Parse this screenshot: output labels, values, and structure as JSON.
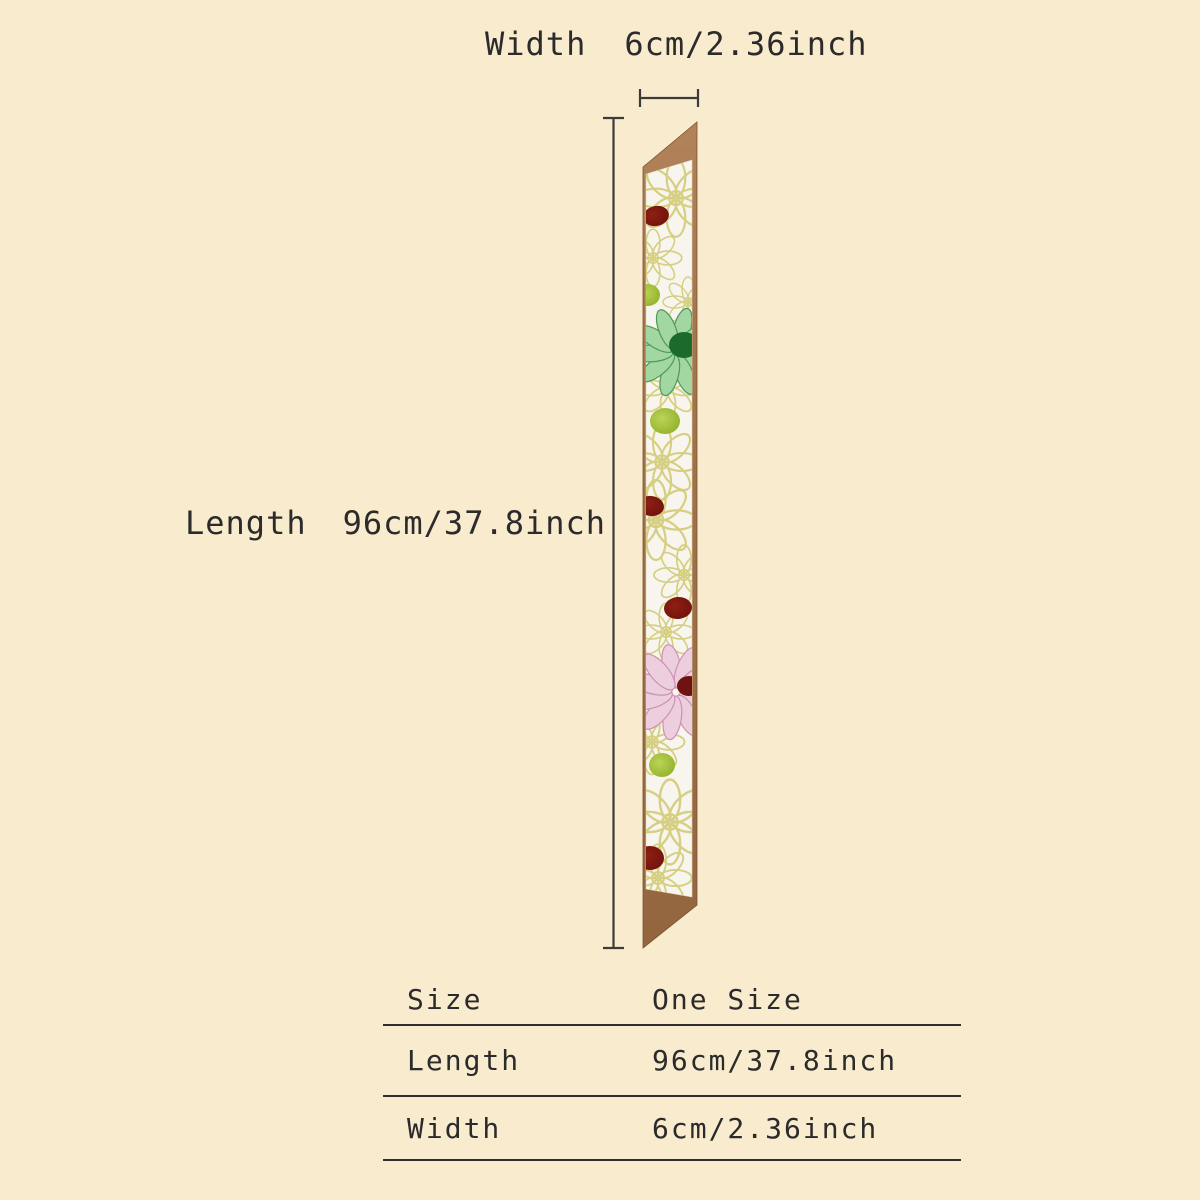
{
  "page": {
    "background_color": "#f9ebcd",
    "text_color": "#2b2b2b",
    "line_color": "#3c3c3c"
  },
  "dimensions": {
    "width": {
      "label": "Width",
      "value": "6cm/2.36inch"
    },
    "length": {
      "label": "Length",
      "value": "96cm/37.8inch"
    }
  },
  "size_table": {
    "rows": [
      {
        "label": "Size",
        "value": "One Size"
      },
      {
        "label": "Length",
        "value": "96cm/37.8inch"
      },
      {
        "label": "Width",
        "value": "6cm/2.36inch"
      }
    ]
  },
  "scarf": {
    "description_colors": {
      "backing_brown": "#a87a4e",
      "backing_brown_dark": "#8a5f38",
      "fabric_white": "#f7f5ee",
      "outline_flower": "#d6cf82",
      "green_daisy_petal": "#a3d7a2",
      "green_daisy_center": "#1d6b2c",
      "lime_pom": "#9fc230",
      "maroon_dot": "#7e150f",
      "pink_daisy_petal": "#eccede",
      "pink_daisy_center": "#6f1210"
    }
  }
}
